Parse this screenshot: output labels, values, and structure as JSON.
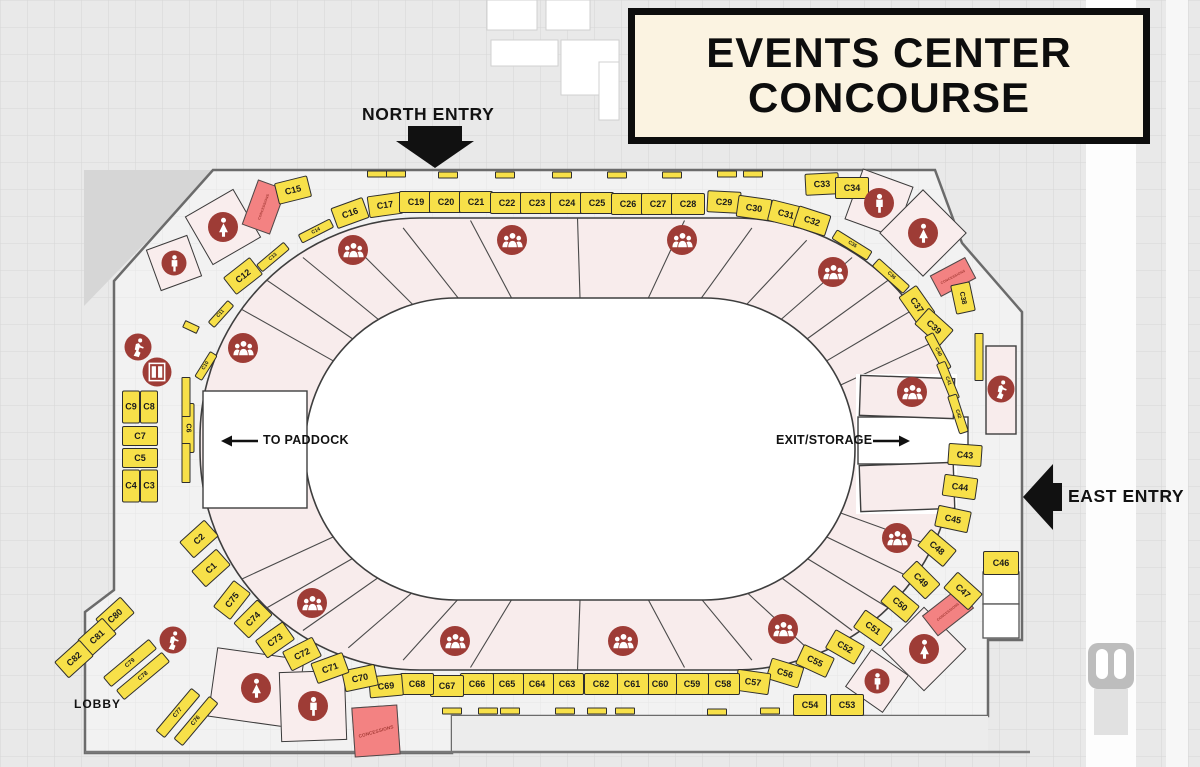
{
  "title": {
    "line1": "EVENTS CENTER",
    "line2": "CONCOURSE"
  },
  "labels": {
    "north_entry": "NORTH ENTRY",
    "east_entry": "EAST ENTRY",
    "to_paddock": "TO PADDOCK",
    "exit_storage": "EXIT/STORAGE",
    "lobby": "LOBBY",
    "concessions": "CONCESSIONS"
  },
  "colors": {
    "booth": "#F7E049",
    "booth_border": "#2E2E2E",
    "ring": "#F8ECEC",
    "arena": "#FFFFFF",
    "icon_circle": "#9E3C36",
    "concession": "#F38282",
    "title_bg": "#FBF3E1",
    "floor": "#F2F2F2",
    "background": "#E9E9E9",
    "wall": "#6B6B6B"
  },
  "icon_names": [
    "crowd-icon",
    "male-restroom-icon",
    "female-restroom-icon",
    "stairs-icon",
    "elevator-icon"
  ],
  "booths": [
    {
      "l": "C1",
      "x": 211,
      "y": 568,
      "r": -42
    },
    {
      "l": "C2",
      "x": 199,
      "y": 539,
      "r": -42
    },
    {
      "l": "C3",
      "x": 149,
      "y": 486,
      "w": 18,
      "h": 33
    },
    {
      "l": "C4",
      "x": 131,
      "y": 486,
      "w": 18,
      "h": 33
    },
    {
      "l": "C5",
      "x": 140,
      "y": 458,
      "w": 36,
      "h": 20
    },
    {
      "l": "C6",
      "x": 188,
      "y": 428,
      "r": 90,
      "w": 50,
      "h": 13,
      "f": 7
    },
    {
      "l": "C7",
      "x": 140,
      "y": 436,
      "w": 36,
      "h": 20
    },
    {
      "l": "C8",
      "x": 149,
      "y": 407,
      "w": 18,
      "h": 33
    },
    {
      "l": "C9",
      "x": 131,
      "y": 407,
      "w": 18,
      "h": 33
    },
    {
      "l": "C10",
      "x": 206,
      "y": 366,
      "r": -58,
      "w": 30,
      "h": 9,
      "f": 5
    },
    {
      "l": "C11",
      "x": 221,
      "y": 314,
      "r": -48,
      "w": 30,
      "h": 9,
      "f": 5
    },
    {
      "l": "C12",
      "x": 243,
      "y": 276,
      "r": -38
    },
    {
      "l": "C13",
      "x": 273,
      "y": 257,
      "r": -40,
      "w": 36,
      "h": 10,
      "f": 5
    },
    {
      "l": "C14",
      "x": 316,
      "y": 231,
      "r": -27,
      "w": 36,
      "h": 10,
      "f": 5
    },
    {
      "l": "C15",
      "x": 293,
      "y": 190,
      "r": -14
    },
    {
      "l": "C16",
      "x": 350,
      "y": 213,
      "r": -20
    },
    {
      "l": "C17",
      "x": 385,
      "y": 205,
      "r": -8
    },
    {
      "l": "C19",
      "x": 416,
      "y": 202
    },
    {
      "l": "C20",
      "x": 446,
      "y": 202
    },
    {
      "l": "C21",
      "x": 476,
      "y": 202
    },
    {
      "l": "C22",
      "x": 507,
      "y": 203
    },
    {
      "l": "C23",
      "x": 537,
      "y": 203
    },
    {
      "l": "C24",
      "x": 567,
      "y": 203
    },
    {
      "l": "C25",
      "x": 597,
      "y": 203
    },
    {
      "l": "C26",
      "x": 628,
      "y": 204
    },
    {
      "l": "C27",
      "x": 658,
      "y": 204
    },
    {
      "l": "C28",
      "x": 688,
      "y": 204
    },
    {
      "l": "C29",
      "x": 724,
      "y": 202,
      "r": 3
    },
    {
      "l": "C30",
      "x": 754,
      "y": 208,
      "r": 8
    },
    {
      "l": "C31",
      "x": 786,
      "y": 214,
      "r": 14
    },
    {
      "l": "C32",
      "x": 812,
      "y": 221,
      "r": 18
    },
    {
      "l": "C33",
      "x": 822,
      "y": 184,
      "r": -3
    },
    {
      "l": "C34",
      "x": 852,
      "y": 188
    },
    {
      "l": "C35",
      "x": 852,
      "y": 245,
      "r": 32,
      "w": 42,
      "h": 11,
      "f": 5
    },
    {
      "l": "C36",
      "x": 891,
      "y": 276,
      "r": 42,
      "w": 42,
      "h": 11,
      "f": 5
    },
    {
      "l": "C37",
      "x": 917,
      "y": 305,
      "r": 55
    },
    {
      "l": "C38",
      "x": 963,
      "y": 298,
      "r": 78,
      "w": 30,
      "h": 20,
      "f": 7
    },
    {
      "l": "C39",
      "x": 934,
      "y": 327,
      "r": 42
    },
    {
      "l": "C40",
      "x": 938,
      "y": 352,
      "r": 62,
      "w": 40,
      "h": 10,
      "f": 5
    },
    {
      "l": "C41",
      "x": 948,
      "y": 381,
      "r": 68,
      "w": 40,
      "h": 10,
      "f": 5
    },
    {
      "l": "C42",
      "x": 958,
      "y": 414,
      "r": 72,
      "w": 40,
      "h": 10,
      "f": 5
    },
    {
      "l": "C43",
      "x": 965,
      "y": 455,
      "r": 4
    },
    {
      "l": "C44",
      "x": 960,
      "y": 487,
      "r": 8
    },
    {
      "l": "C45",
      "x": 953,
      "y": 519,
      "r": 12
    },
    {
      "l": "C46",
      "x": 1001,
      "y": 563,
      "w": 36,
      "h": 24
    },
    {
      "l": "C47",
      "x": 963,
      "y": 591,
      "r": 42
    },
    {
      "l": "C48",
      "x": 937,
      "y": 548,
      "r": 40
    },
    {
      "l": "C49",
      "x": 921,
      "y": 580,
      "r": 45
    },
    {
      "l": "C50",
      "x": 900,
      "y": 604,
      "r": 40
    },
    {
      "l": "C51",
      "x": 873,
      "y": 628,
      "r": 35
    },
    {
      "l": "C52",
      "x": 845,
      "y": 647,
      "r": 30
    },
    {
      "l": "C53",
      "x": 847,
      "y": 705
    },
    {
      "l": "C54",
      "x": 810,
      "y": 705
    },
    {
      "l": "C55",
      "x": 815,
      "y": 661,
      "r": 25
    },
    {
      "l": "C56",
      "x": 785,
      "y": 673,
      "r": 17
    },
    {
      "l": "C57",
      "x": 753,
      "y": 682,
      "r": 8
    },
    {
      "l": "C58",
      "x": 723,
      "y": 684
    },
    {
      "l": "C59",
      "x": 692,
      "y": 684
    },
    {
      "l": "C60",
      "x": 660,
      "y": 684
    },
    {
      "l": "C61",
      "x": 632,
      "y": 684
    },
    {
      "l": "C62",
      "x": 601,
      "y": 684
    },
    {
      "l": "C63",
      "x": 567,
      "y": 684
    },
    {
      "l": "C64",
      "x": 537,
      "y": 684
    },
    {
      "l": "C65",
      "x": 507,
      "y": 684
    },
    {
      "l": "C66",
      "x": 477,
      "y": 684
    },
    {
      "l": "C67",
      "x": 447,
      "y": 686
    },
    {
      "l": "C68",
      "x": 417,
      "y": 684
    },
    {
      "l": "C69",
      "x": 386,
      "y": 686,
      "r": -5
    },
    {
      "l": "C70",
      "x": 360,
      "y": 678,
      "r": -12
    },
    {
      "l": "C71",
      "x": 330,
      "y": 668,
      "r": -20
    },
    {
      "l": "C72",
      "x": 302,
      "y": 654,
      "r": -27
    },
    {
      "l": "C73",
      "x": 275,
      "y": 640,
      "r": -35
    },
    {
      "l": "C74",
      "x": 253,
      "y": 619,
      "r": -45
    },
    {
      "l": "C75",
      "x": 232,
      "y": 600,
      "r": -52
    },
    {
      "l": "C76",
      "x": 196,
      "y": 721,
      "r": -50,
      "w": 56,
      "h": 12,
      "f": 6
    },
    {
      "l": "C77",
      "x": 178,
      "y": 713,
      "r": -50,
      "w": 56,
      "h": 12,
      "f": 6
    },
    {
      "l": "C78",
      "x": 143,
      "y": 676,
      "r": -40,
      "w": 60,
      "h": 13,
      "f": 6
    },
    {
      "l": "C79",
      "x": 130,
      "y": 663,
      "r": -40,
      "w": 60,
      "h": 13,
      "f": 6
    },
    {
      "l": "C80",
      "x": 115,
      "y": 616,
      "r": -42
    },
    {
      "l": "C81",
      "x": 97,
      "y": 637,
      "r": -42
    },
    {
      "l": "C82",
      "x": 74,
      "y": 659,
      "r": -42
    }
  ],
  "mini_strips": [
    [
      377,
      174
    ],
    [
      396,
      174
    ],
    [
      448,
      175
    ],
    [
      505,
      175
    ],
    [
      562,
      175
    ],
    [
      617,
      175
    ],
    [
      672,
      175
    ],
    [
      727,
      174
    ],
    [
      753,
      174
    ],
    [
      452,
      711
    ],
    [
      488,
      711
    ],
    [
      510,
      711
    ],
    [
      565,
      711
    ],
    [
      597,
      711
    ],
    [
      625,
      711
    ],
    [
      717,
      712
    ],
    [
      770,
      711
    ],
    [
      186,
      397,
      90,
      40,
      9
    ],
    [
      186,
      463,
      90,
      40,
      9
    ],
    [
      979,
      357,
      90,
      48,
      9
    ],
    [
      191,
      327,
      25,
      16,
      8
    ]
  ],
  "crowd_icons": [
    [
      353,
      250
    ],
    [
      512,
      240
    ],
    [
      682,
      240
    ],
    [
      833,
      272
    ],
    [
      243,
      348
    ],
    [
      912,
      392
    ],
    [
      897,
      538
    ],
    [
      312,
      603
    ],
    [
      455,
      641
    ],
    [
      623,
      641
    ],
    [
      783,
      629
    ]
  ],
  "restroom_diamonds": [
    {
      "x": 223,
      "y": 227,
      "s": 56,
      "r": -30,
      "icon": "female"
    },
    {
      "x": 174,
      "y": 263,
      "s": 44,
      "r": -20,
      "icon": "male"
    },
    {
      "x": 879,
      "y": 203,
      "s": 54,
      "r": 20,
      "icon": "male"
    },
    {
      "x": 923,
      "y": 233,
      "s": 62,
      "r": 45,
      "icon": "female"
    },
    {
      "x": 924,
      "y": 649,
      "s": 60,
      "r": 45,
      "icon": "female"
    },
    {
      "x": 877,
      "y": 681,
      "s": 46,
      "r": 35,
      "icon": "male"
    }
  ],
  "restroom_rooms": [
    {
      "x": 256,
      "y": 688,
      "w": 88,
      "h": 70,
      "r": 8,
      "icon": "female"
    },
    {
      "x": 313,
      "y": 706,
      "w": 66,
      "h": 70,
      "r": -2,
      "icon": "male"
    }
  ],
  "stair_icons": [
    [
      138,
      347
    ],
    [
      173,
      640
    ],
    [
      1001,
      389
    ]
  ],
  "elevator_icons": [
    [
      157,
      372
    ]
  ],
  "stair_room": {
    "x": 1001,
    "y": 390,
    "w": 30,
    "h": 88
  },
  "concessions": [
    {
      "x": 264,
      "y": 207,
      "w": 30,
      "h": 48,
      "r": 20,
      "text_rot": -90,
      "big": false
    },
    {
      "x": 953,
      "y": 277,
      "w": 40,
      "h": 24,
      "r": -28,
      "text_rot": 0,
      "big": false
    },
    {
      "x": 948,
      "y": 612,
      "w": 46,
      "h": 26,
      "r": -38,
      "text_rot": 0,
      "big": false
    },
    {
      "x": 376,
      "y": 731,
      "w": 46,
      "h": 50,
      "r": -4,
      "text_rot": -12,
      "big": true
    }
  ]
}
